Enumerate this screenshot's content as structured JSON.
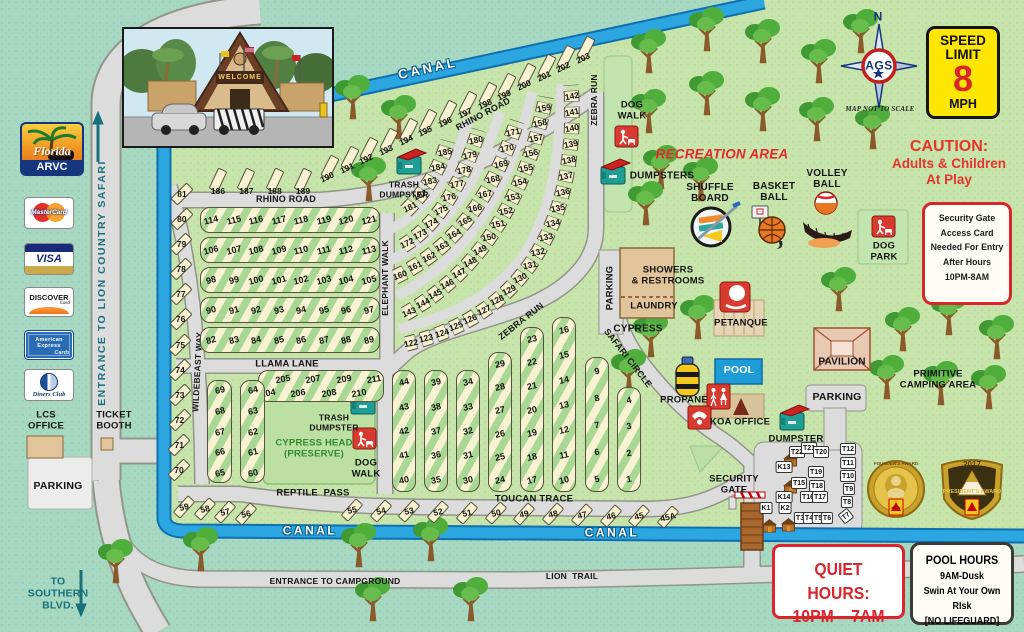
{
  "labels": {
    "canal": "CANAL",
    "entrance_safari": "ENTRANCE TO LION COUNTRY SAFARI",
    "to_southern": "TO\nSOUTHERN\nBLVD.",
    "entrance_campground": "ENTRANCE TO CAMPGROUND",
    "lion_trail": "LION  TRAIL",
    "rhino_road": "RHINO ROAD",
    "elephant_walk": "ELEPHANT WALK",
    "zebra_run": "ZEBRA RUN",
    "llama_lane": "LLAMA LANE",
    "wildebeast_way": "WILDEBEAST WAY",
    "reptile_pass": "REPTILE  PASS",
    "toucan_trace": "TOUCAN TRACE",
    "safari_circle": "SAFARI CIRCLE",
    "cypress": "CYPRESS",
    "parking": "PARKING",
    "ticket_booth": "TICKET\nBOOTH",
    "lcs_office": "LCS\nOFFICE",
    "trash_dumpster": "TRASH\nDUMPSTER",
    "dumpsters": "DUMPSTERS",
    "dumpster": "DUMPSTER",
    "dog_walk": "DOG\nWALK",
    "dog_park": "DOG\nPARK",
    "recreation_area": "RECREATION AREA",
    "shuffle_board": "SHUFFLE\nBOARD",
    "basket_ball": "BASKET\nBALL",
    "volley_ball": "VOLLEY\nBALL",
    "showers": "SHOWERS\n& RESTROOMS",
    "laundry": "LAUNDRY",
    "petanque": "PETANQUE",
    "pool": "POOL",
    "propane": "PROPANE",
    "koa_office": "KOA OFFICE",
    "pavilion": "PAVILION",
    "primitive": "PRIMITIVE\nCAMPING AREA",
    "security_gate": "SECURITY\nGATE",
    "cypress_head": "CYPRESS HEAD\n(PRESERVE)"
  },
  "signs": {
    "speed": [
      "SPEED",
      "LIMIT",
      "8",
      "MPH"
    ],
    "caution_title": "CAUTION:",
    "caution_l1": "Adults & Children",
    "caution_l2": "At Play",
    "access": [
      "Security Gate",
      "Access Card",
      "Needed For Entry",
      "After Hours",
      "10PM-8AM"
    ],
    "quiet_title": "QUIET HOURS:",
    "quiet_value": "10PM – 7AM",
    "pool_hours": [
      "POOL HOURS",
      "9AM-Dusk",
      "Swin At Your Own RIsk",
      "[NO LIFEGUARD]"
    ],
    "map_scale": "MAP NOT TO SCALE",
    "north": "N",
    "ags": "AGS",
    "welcome": "WELCOME"
  },
  "logos": {
    "florida": "Florida",
    "arvc": "ARVC",
    "cards": {
      "mastercard": "MasterCard",
      "visa": "VISA",
      "discover": "DISCOVER",
      "discover_sub": "Card",
      "amex": "American Express",
      "amex_sub": "Cards",
      "diners": "Diners Club"
    }
  },
  "badges": {
    "founders": "FOUNDER'S AWARD",
    "presidents_year": "2017",
    "presidents": "PRESIDENT'S AWARD",
    "koa": "KOA"
  },
  "sites": {
    "row_114_121": [
      "114",
      "115",
      "116",
      "117",
      "118",
      "119",
      "120",
      "121"
    ],
    "row_106_113": [
      "106",
      "107",
      "108",
      "109",
      "110",
      "111",
      "112",
      "113"
    ],
    "row_98_105": [
      "98",
      "99",
      "100",
      "101",
      "102",
      "103",
      "104",
      "105"
    ],
    "row_90_97": [
      "90",
      "91",
      "92",
      "93",
      "94",
      "95",
      "96",
      "97"
    ],
    "row_82_89": [
      "82",
      "83",
      "84",
      "85",
      "86",
      "87",
      "88",
      "89"
    ],
    "row_204_211": [
      "204",
      "205",
      "206",
      "207",
      "208",
      "209",
      "210",
      "211"
    ],
    "col_69_65": [
      "69",
      "68",
      "67",
      "66",
      "65"
    ],
    "col_64_60": [
      "64",
      "63",
      "62",
      "61",
      "60"
    ],
    "col_44_40": [
      "44",
      "43",
      "42",
      "41",
      "40"
    ],
    "col_39_35": [
      "39",
      "38",
      "37",
      "36",
      "35"
    ],
    "col_34_30": [
      "34",
      "33",
      "32",
      "31",
      "30"
    ],
    "col_29_24": [
      "29",
      "28",
      "27",
      "26",
      "25",
      "24"
    ],
    "col_23_17": [
      "23",
      "22",
      "21",
      "20",
      "19",
      "18",
      "17"
    ],
    "col_16_10": [
      "16",
      "15",
      "14",
      "13",
      "12",
      "11",
      "10"
    ],
    "col_9_5": [
      "9",
      "8",
      "7",
      "6",
      "5"
    ],
    "col_4_1": [
      "4",
      "3",
      "2",
      "1"
    ],
    "wildebeast_sites": [
      "81",
      "80",
      "79",
      "78",
      "77",
      "76",
      "75",
      "74",
      "73",
      "72",
      "71",
      "70"
    ],
    "reptile_sites": [
      "59",
      "58",
      "57",
      "56"
    ],
    "toucan_sites": [
      "55",
      "54",
      "53",
      "52",
      "51",
      "50",
      "49",
      "48",
      "47",
      "46",
      "45",
      "45A"
    ],
    "row_186_189": [
      "186",
      "187",
      "188",
      "189"
    ],
    "canal_sites": [
      "190",
      "191",
      "192",
      "193",
      "194",
      "195",
      "196",
      "197",
      "198",
      "199",
      "200",
      "201",
      "202",
      "203"
    ],
    "arc_181_185": [
      "181",
      "182",
      "183",
      "184",
      "185"
    ],
    "ring_172_180": [
      "172",
      "173",
      "174",
      "175",
      "176",
      "177",
      "178",
      "179",
      "180"
    ],
    "ring_160_171": [
      "160",
      "161",
      "162",
      "163",
      "164",
      "165",
      "166",
      "167",
      "168",
      "169",
      "170",
      "171"
    ],
    "ring_143_159": [
      "143",
      "144",
      "145",
      "146",
      "147",
      "148",
      "149",
      "150",
      "151",
      "152",
      "153",
      "154",
      "155",
      "156",
      "157",
      "158",
      "159"
    ],
    "ring_122_142": [
      "122",
      "123",
      "124",
      "125",
      "126",
      "127",
      "128",
      "129",
      "130",
      "131",
      "132",
      "133",
      "134",
      "135",
      "136",
      "137",
      "138",
      "139",
      "140",
      "141",
      "142"
    ],
    "t_sites": [
      "T22",
      "T21",
      "T20",
      "K13",
      "T19",
      "T15",
      "T18",
      "T16",
      "T17",
      "K14",
      "T12",
      "T11",
      "T10",
      "T9",
      "T8",
      "T7",
      "K1",
      "K2",
      "T3",
      "T4",
      "T5",
      "T6"
    ]
  }
}
